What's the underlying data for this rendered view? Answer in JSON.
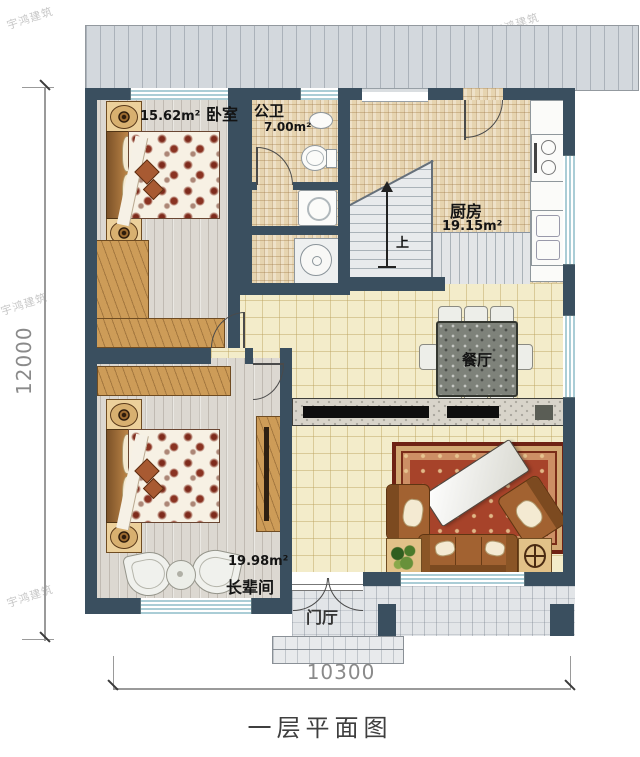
{
  "title": "一层平面图",
  "watermark": "宇鸿建筑",
  "dimensions": {
    "height_label": "12000",
    "width_label": "10300"
  },
  "rooms": {
    "bedroom": {
      "name": "卧室",
      "area": "15.62m²"
    },
    "bathroom": {
      "name": "公卫",
      "area": "7.00m²"
    },
    "kitchen": {
      "name": "厨房",
      "area": "19.15m²"
    },
    "dining": {
      "name": "餐厅"
    },
    "elder": {
      "name": "长辈间",
      "area": "19.98m²"
    },
    "foyer": {
      "name": "门厅"
    }
  },
  "stairs": {
    "up_label": "上"
  },
  "colors": {
    "wall": "#3a4f5f",
    "window": "#aacdd6",
    "tile": "#f3ecca",
    "mosaic": "#e6d4b0",
    "wood_floor": "#dcd8d1",
    "wood": "#cd9c58",
    "rug": "#a7432a",
    "sofa": "#a26231",
    "terrace": "#d3d8dd"
  }
}
